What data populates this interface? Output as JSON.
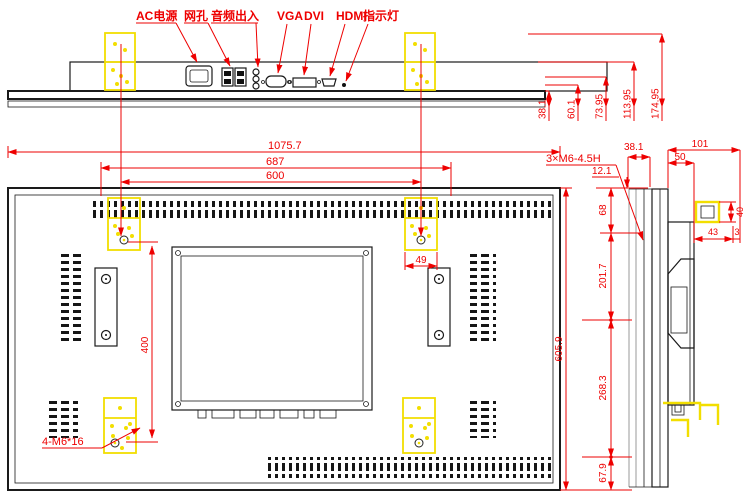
{
  "colors": {
    "dimension_red": "#ff0000",
    "outline_black": "#1a1a1a",
    "highlight_yellow": "#ffff00",
    "secondary_gray": "#9a9a9a"
  },
  "labels": {
    "connectors": [
      {
        "text": "AC电源"
      },
      {
        "text": "网孔"
      },
      {
        "text": "音频出入"
      },
      {
        "text": "VGA"
      },
      {
        "text": "DVI"
      },
      {
        "text": "HDMI"
      },
      {
        "text": "指示灯"
      }
    ]
  },
  "dims": {
    "depths": [
      "38.1",
      "60.1",
      "73.95",
      "113.95",
      "174.95"
    ],
    "widths": [
      "1075.7",
      "687",
      "600"
    ],
    "height_overall": "605.9",
    "height_chain": [
      "68",
      "201.7",
      "268.3",
      "67.9"
    ],
    "top_offset": "12.1",
    "vesa_vertical": "400",
    "bracket_width": "49",
    "screw_note": "4-M6*16",
    "thread_note": "3×M6-4.5H",
    "side": {
      "bezel_depth": "38.1",
      "total_depth": "101",
      "box_depth": "50",
      "ear_height": "40",
      "ear_length": "43",
      "ear_thickness": "3"
    }
  }
}
